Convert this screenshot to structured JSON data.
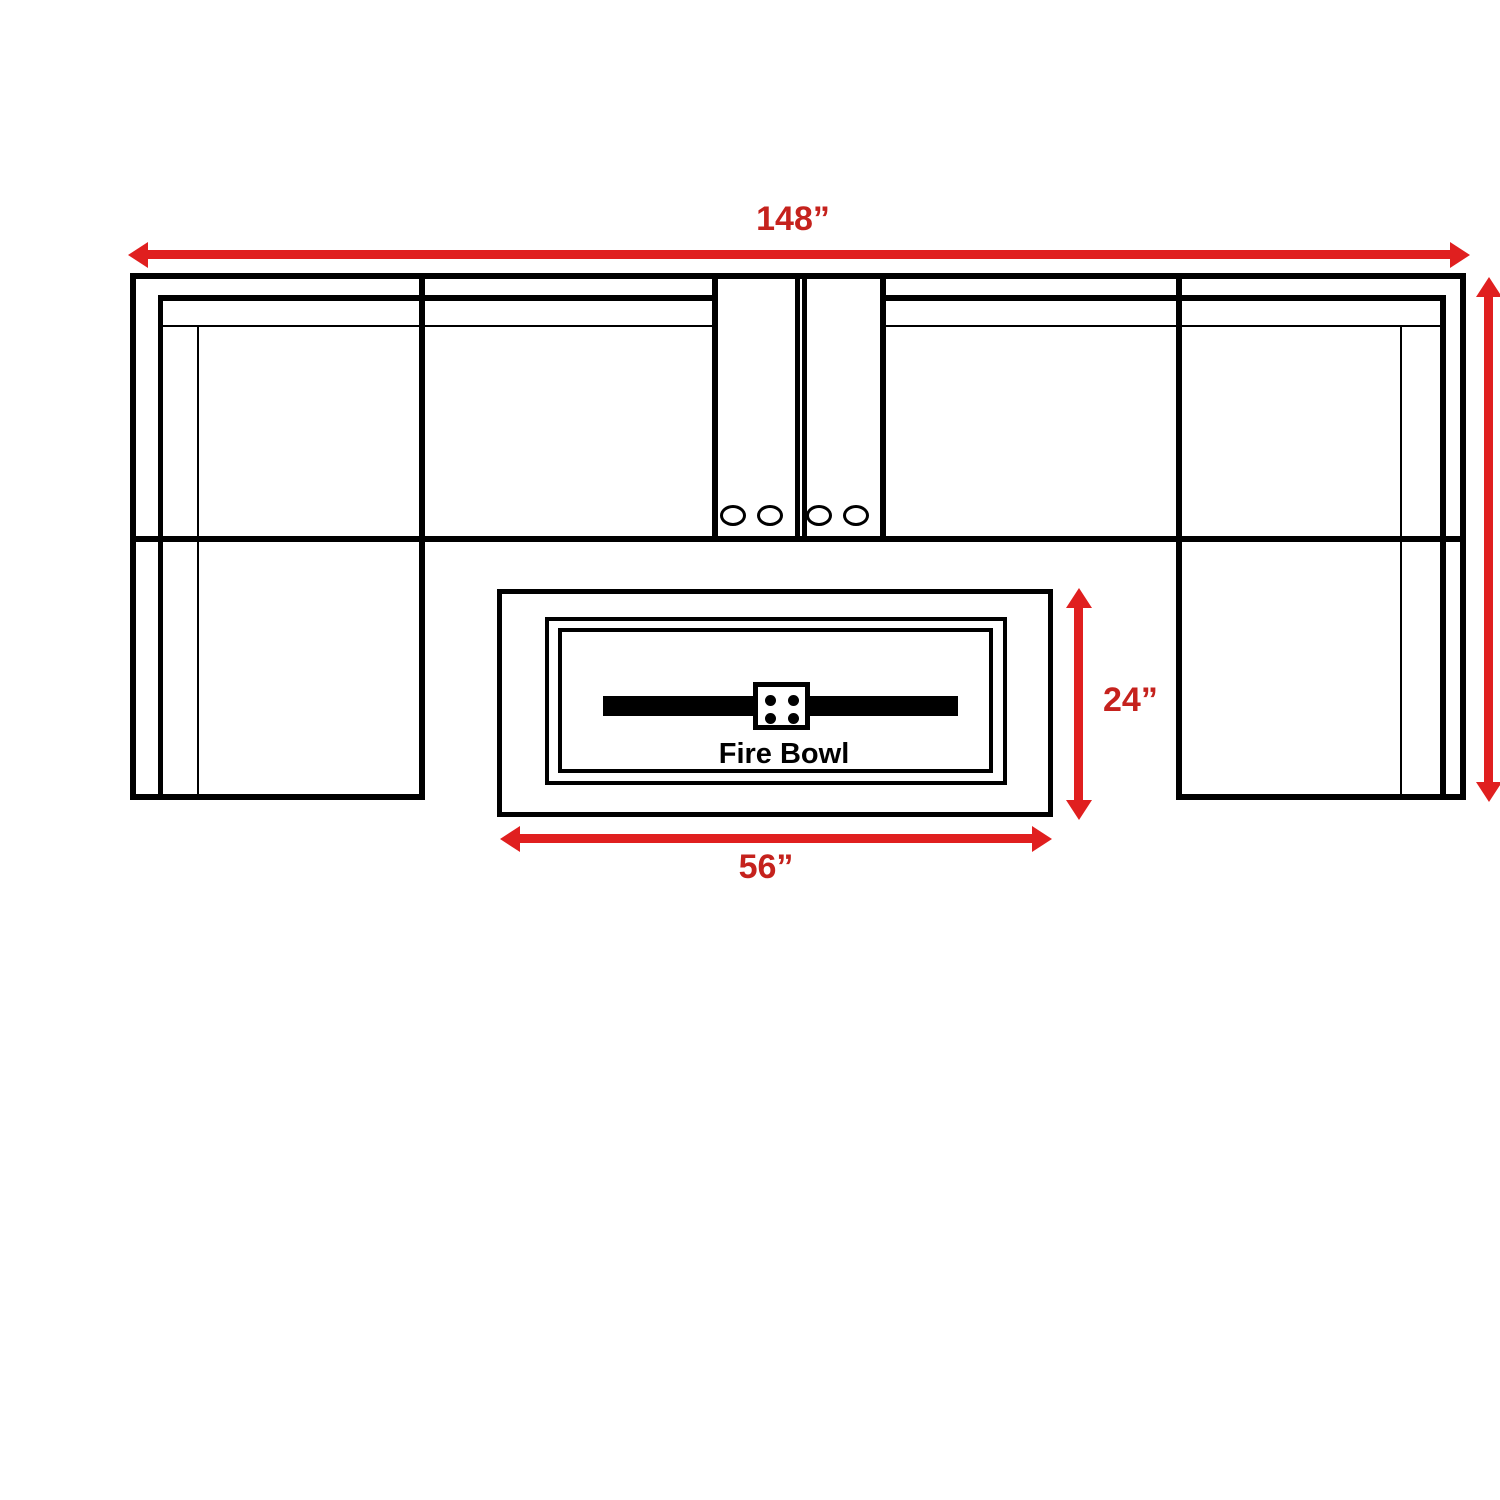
{
  "page": {
    "title": "Sectional Sofa with Fire Bowl — Dimension Diagram"
  },
  "colors": {
    "line": "#000000",
    "arrow_red": "#e01f1f",
    "label_red": "#c5221d",
    "background": "#ffffff"
  },
  "dimensions": {
    "overall_width": {
      "label": "148”"
    },
    "fire_table_depth": {
      "label": "24”"
    },
    "fire_table_width": {
      "label": "56”"
    }
  },
  "fire_table": {
    "label": "Fire Bowl"
  }
}
